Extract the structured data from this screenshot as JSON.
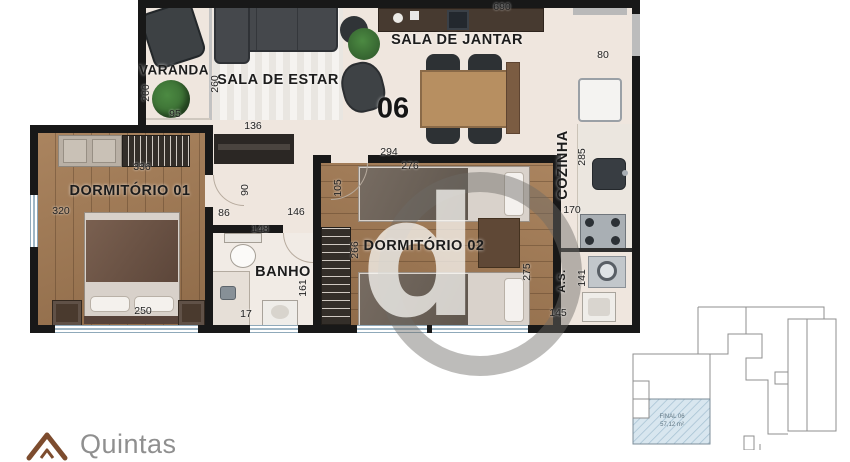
{
  "plan": {
    "unit_number": "06",
    "watermark_letter": "d",
    "rooms": {
      "varanda": "VARANDA",
      "sala_estar": "SALA DE ESTAR",
      "sala_jantar": "SALA DE JANTAR",
      "cozinha": "COZINHA",
      "dormitorio1": "DORMITÓRIO 01",
      "dormitorio2": "DORMITÓRIO 02",
      "banho": "BANHO",
      "area_servico": "A.S."
    },
    "dimensions": {
      "d690": "690",
      "d80": "80",
      "d200": "200",
      "d95": "95",
      "d260": "260",
      "d136": "136",
      "d336": "336",
      "d320": "320",
      "d250": "250",
      "d90": "90",
      "d86": "86",
      "d146": "146",
      "d105": "105",
      "d148": "148",
      "d161": "161",
      "d17": "17",
      "d294": "294",
      "d276": "276",
      "d266": "266",
      "d275": "275",
      "d285": "285",
      "d170": "170",
      "d141": "141",
      "d145": "145"
    }
  },
  "keyplan": {
    "unit_label": "FINAL 06",
    "area_label": "57,12 m²"
  },
  "brand": {
    "name": "Quintas"
  },
  "colors": {
    "wall": "#181818",
    "floor": "#efe6de",
    "wood": "#a17c58",
    "keyplan_highlight": "#d8e6ef",
    "brand_icon": "#7d4c2e",
    "brand_text": "#8f8f8f"
  }
}
